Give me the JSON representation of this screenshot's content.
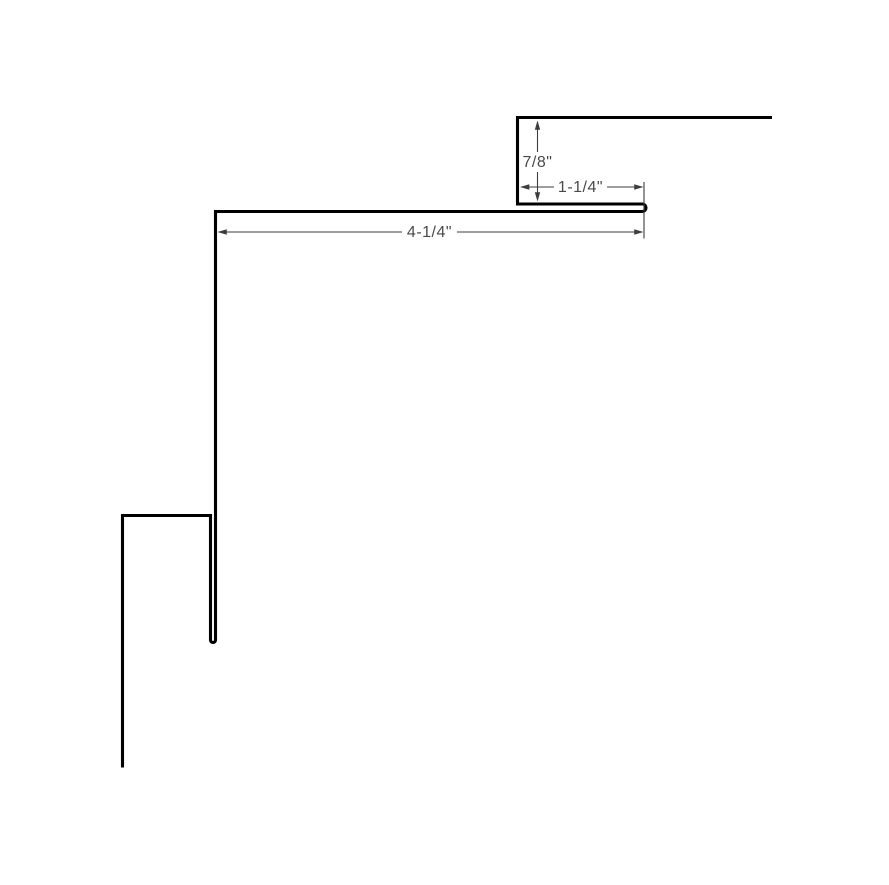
{
  "drawing": {
    "type": "sheet-metal-profile-cross-section",
    "background_color": "#ffffff",
    "profile_line_color": "#000000",
    "dimension_line_color": "#3d3d3d",
    "dimension_text_color": "#4a4a4a",
    "dimensions": [
      {
        "name": "leg-height",
        "label": "7/8\"",
        "orientation": "vertical"
      },
      {
        "name": "hem-length",
        "label": "1-1/4\"",
        "orientation": "horizontal"
      },
      {
        "name": "top-run-length",
        "label": "4-1/4\"",
        "orientation": "horizontal"
      }
    ]
  }
}
